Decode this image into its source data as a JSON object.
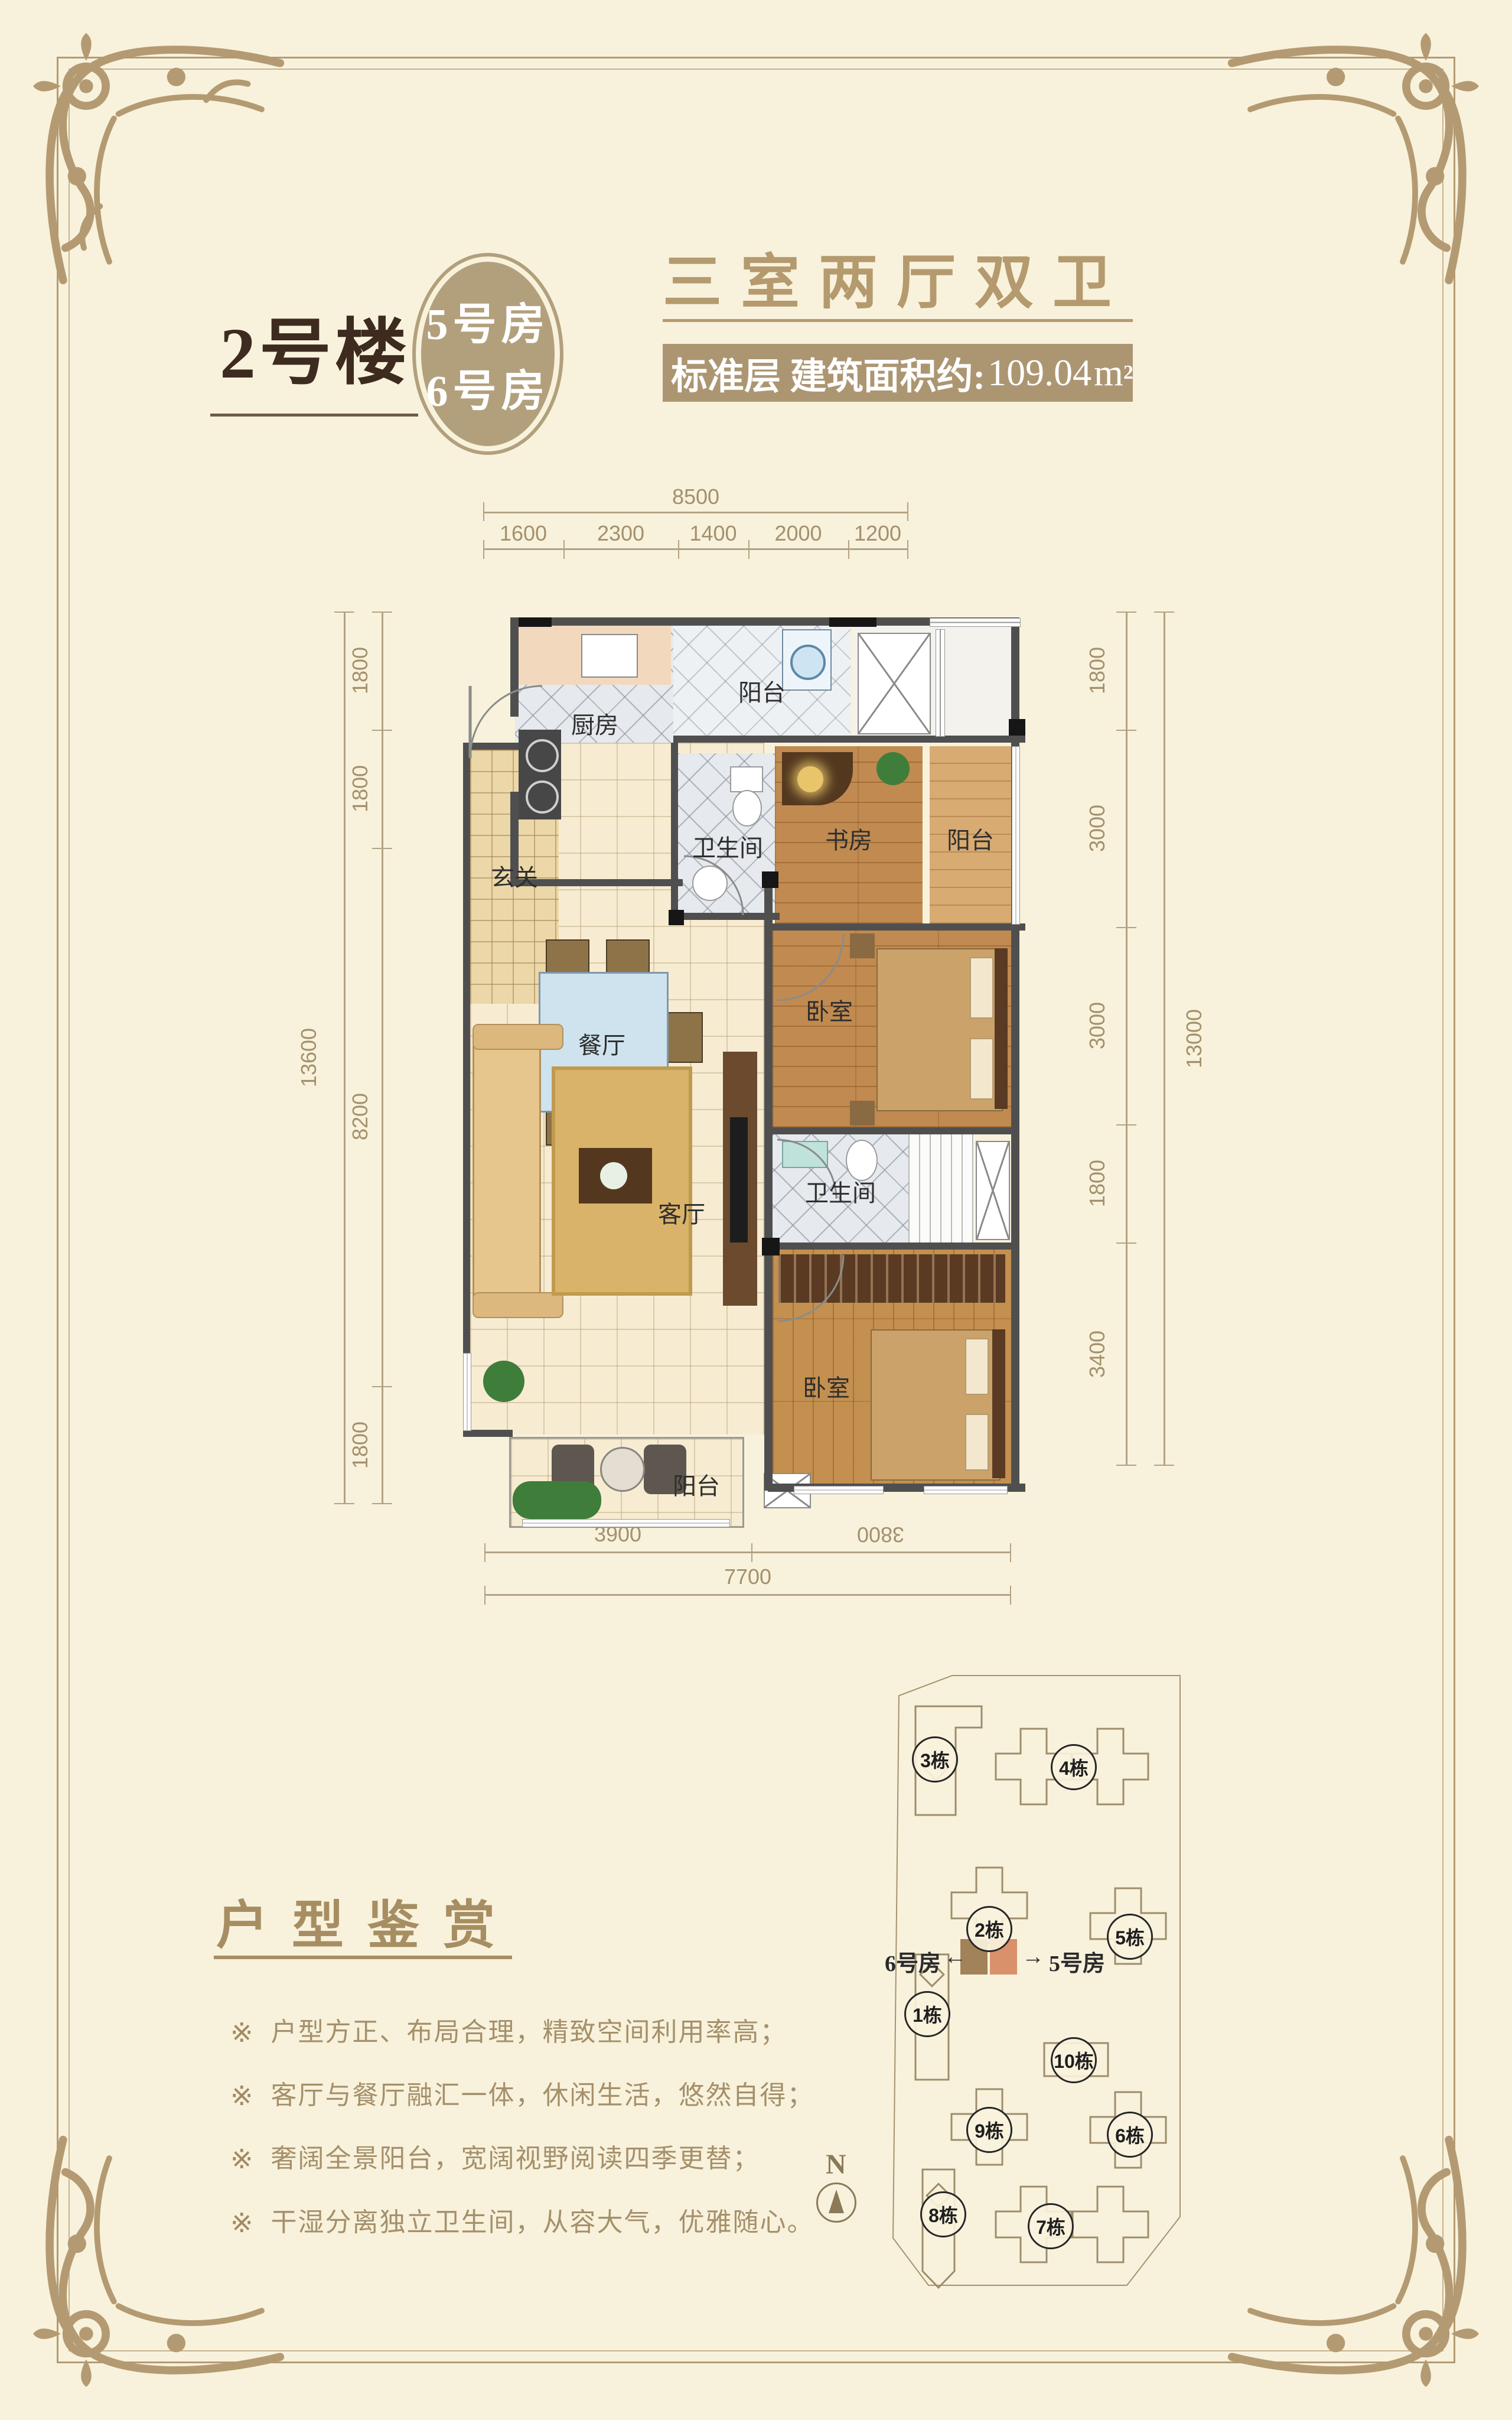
{
  "colors": {
    "background": "#f8f2dc",
    "frame_accent": "#b49a72",
    "dark_title": "#3c2b1e",
    "tan_title": "#b49a6e",
    "area_box_bg": "#ac9672",
    "dimension_text": "#a3906c",
    "wall": "#4f4f4f",
    "highlight_unit_left": "#a18259",
    "highlight_unit_right": "#d8916b"
  },
  "header": {
    "building_label": "2号楼",
    "badge": {
      "line1": "5号房",
      "line2": "6号房"
    },
    "layout_title": "三室两厅双卫",
    "area": {
      "prefix": "标准层 建筑面积约:",
      "value": "109.04",
      "unit": "m",
      "sup": "2"
    }
  },
  "floor_plan": {
    "rooms": {
      "kitchen": "厨房",
      "balcony_top": "阳台",
      "entry": "玄关",
      "bath_top": "卫生间",
      "study": "书房",
      "study_balcony": "阳台",
      "dining": "餐厅",
      "bedroom_mid": "卧室",
      "living": "客厅",
      "bath_mid": "卫生间",
      "bedroom_bottom": "卧室",
      "balcony_bottom": "阳台"
    },
    "dimensions": {
      "top_total": "8500",
      "top_segments": [
        "1600",
        "2300",
        "1400",
        "2000",
        "1200"
      ],
      "left_total": "13600",
      "left_segments": [
        "1800",
        "1800",
        "8200",
        "1800"
      ],
      "right_total": "13000",
      "right_segments": [
        "1800",
        "3000",
        "3000",
        "1800",
        "3400"
      ],
      "bottom_segments": [
        "3900",
        "3800"
      ],
      "bottom_total": "7700"
    }
  },
  "highlights": {
    "title": "户型鉴赏",
    "marker": "※",
    "items": [
      "户型方正、布局合理，精致空间利用率高；",
      "客厅与餐厅融汇一体，休闲生活，悠然自得；",
      "奢阔全景阳台，宽阔视野阅读四季更替；",
      "干湿分离独立卫生间，从容大气，优雅随心。"
    ]
  },
  "site_map": {
    "buildings": [
      {
        "label": "3栋"
      },
      {
        "label": "4栋"
      },
      {
        "label": "2栋"
      },
      {
        "label": "5栋"
      },
      {
        "label": "1栋"
      },
      {
        "label": "10栋"
      },
      {
        "label": "9栋"
      },
      {
        "label": "6栋"
      },
      {
        "label": "8栋"
      },
      {
        "label": "7栋"
      }
    ],
    "unit_left": "6号房",
    "unit_right": "5号房",
    "arrow_left": "←",
    "arrow_right": "→",
    "compass_n": "N"
  }
}
